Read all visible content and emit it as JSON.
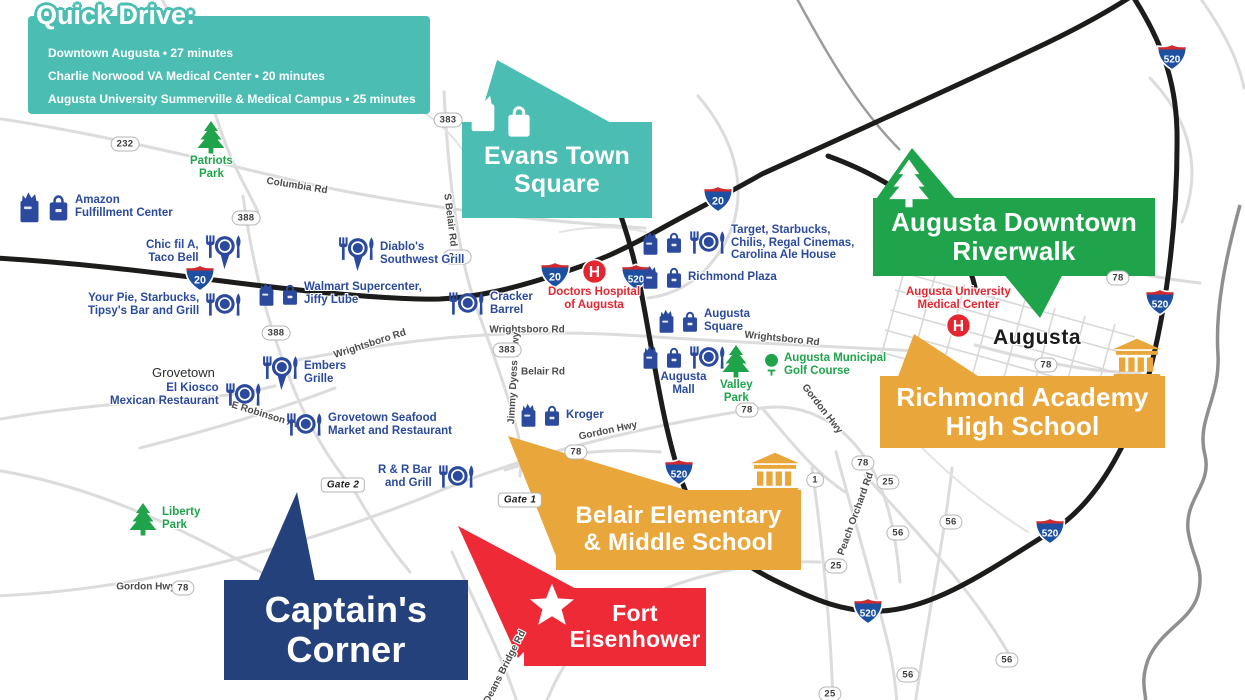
{
  "colors": {
    "teal": "#4CBDB2",
    "green": "#1FA44C",
    "orange": "#E9A63B",
    "red": "#ED2A35",
    "navy": "#24417C",
    "blue_label": "#2B4A9E",
    "red_label": "#E42630",
    "green_label": "#1FA44C",
    "road_black": "#1C1C1A",
    "road_gray": "#DCDCDC",
    "river_gray": "#8F8F8F"
  },
  "quick_drive": {
    "title": "Quick Drive:",
    "items": [
      "Downtown Augusta • 27 minutes",
      "Charlie Norwood VA Medical Center • 20 minutes",
      "Augusta University Summerville & Medical Campus • 25 minutes"
    ]
  },
  "callouts": {
    "evans": {
      "line1": "Evans Town",
      "line2": "Square"
    },
    "riverwalk": {
      "line1": "Augusta Downtown",
      "line2": "Riverwalk"
    },
    "richmond": {
      "line1": "Richmond Academy",
      "line2": "High School"
    },
    "belair": {
      "line1": "Belair Elementary",
      "line2": "& Middle School"
    },
    "fort": {
      "line1": "Fort",
      "line2": "Eisenhower"
    },
    "captains": {
      "line1": "Captain's",
      "line2": "Corner"
    }
  },
  "pois": [
    {
      "id": "amazon-fulfillment-center",
      "x": 16,
      "y": 190,
      "big": true,
      "icons": [
        "grocery",
        "shopping"
      ],
      "lines": [
        "Amazon",
        "Fulfillment Center"
      ]
    },
    {
      "id": "patriots-park",
      "x": 190,
      "y": 120,
      "style": "green",
      "layout": "col",
      "icons": [
        "tree"
      ],
      "lines": [
        "Patriots",
        "Park"
      ]
    },
    {
      "id": "chic-fil-a-taco-bell",
      "x": 146,
      "y": 234,
      "iconside": "right",
      "align": "right",
      "icons": [
        "restaurant-pin"
      ],
      "lines": [
        "Chic fil A,",
        "Taco Bell"
      ]
    },
    {
      "id": "diablos-southwest-grill",
      "x": 336,
      "y": 236,
      "icons": [
        "restaurant-pin"
      ],
      "lines": [
        "Diablo's",
        "Southwest Grill"
      ]
    },
    {
      "id": "your-pie-starbucks-tipsys",
      "x": 88,
      "y": 292,
      "iconside": "right",
      "align": "right",
      "icons": [
        "restaurant"
      ],
      "lines": [
        "Your Pie, Starbucks,",
        "Tipsy's Bar and Grill"
      ]
    },
    {
      "id": "walmart-supercenter-jiffy-lube",
      "x": 256,
      "y": 281,
      "icons": [
        "grocery",
        "shopping"
      ],
      "lines": [
        "Walmart Supercenter,",
        "Jiffy Lube"
      ]
    },
    {
      "id": "cracker-barrel",
      "x": 446,
      "y": 291,
      "icons": [
        "restaurant"
      ],
      "lines": [
        "Cracker",
        "Barrel"
      ]
    },
    {
      "id": "doctors-hospital-of-augusta",
      "x": 548,
      "y": 258,
      "style": "red",
      "layout": "col",
      "icons": [
        "hospital"
      ],
      "lines": [
        "Doctors Hospital",
        "of Augusta"
      ]
    },
    {
      "id": "target-starbucks-chilis",
      "x": 640,
      "y": 224,
      "icons": [
        "grocery",
        "shopping",
        "restaurant"
      ],
      "lines": [
        "Target, Starbucks,",
        "Chilis, Regal Cinemas,",
        "Carolina Ale House"
      ]
    },
    {
      "id": "richmond-plaza",
      "x": 640,
      "y": 264,
      "icons": [
        "grocery",
        "shopping"
      ],
      "lines": [
        "Richmond Plaza"
      ]
    },
    {
      "id": "augusta-square",
      "x": 656,
      "y": 308,
      "icons": [
        "grocery",
        "shopping"
      ],
      "lines": [
        "Augusta",
        "Square"
      ]
    },
    {
      "id": "augusta-mall",
      "x": 640,
      "y": 344,
      "layout": "col",
      "icons": [
        "grocery",
        "shopping",
        "restaurant"
      ],
      "lines": [
        "Augusta",
        "Mall"
      ]
    },
    {
      "id": "valley-park",
      "x": 720,
      "y": 344,
      "style": "green",
      "layout": "col",
      "icons": [
        "tree"
      ],
      "lines": [
        "Valley",
        "Park"
      ]
    },
    {
      "id": "augusta-municipal-golf-course",
      "x": 763,
      "y": 352,
      "style": "green",
      "icons": [
        "golf"
      ],
      "lines": [
        "Augusta Municipal",
        "Golf Course"
      ]
    },
    {
      "id": "augusta-university-medical-center",
      "x": 906,
      "y": 286,
      "style": "red",
      "layout": "col",
      "iconafter": true,
      "icons": [
        "hospital"
      ],
      "lines": [
        "Augusta University",
        "Medical Center"
      ]
    },
    {
      "id": "augusta-city",
      "x": 993,
      "y": 326,
      "style": "city",
      "icons": [],
      "lines": [
        "Augusta"
      ]
    },
    {
      "id": "grovetown-city",
      "x": 152,
      "y": 366,
      "style": "town",
      "icons": [],
      "lines": [
        "Grovetown"
      ]
    },
    {
      "id": "embers-grille",
      "x": 260,
      "y": 355,
      "icons": [
        "restaurant-pin"
      ],
      "lines": [
        "Embers",
        "Grille"
      ]
    },
    {
      "id": "el-kiosco-mexican-restaurant",
      "x": 110,
      "y": 382,
      "iconside": "right",
      "align": "right",
      "icons": [
        "restaurant"
      ],
      "lines": [
        "El Kiosco",
        "Mexican Restaurant"
      ]
    },
    {
      "id": "grovetown-seafood-market",
      "x": 284,
      "y": 412,
      "icons": [
        "restaurant"
      ],
      "lines": [
        "Grovetown Seafood",
        "Market and Restaurant"
      ]
    },
    {
      "id": "kroger",
      "x": 518,
      "y": 402,
      "icons": [
        "grocery",
        "shopping"
      ],
      "lines": [
        "Kroger"
      ]
    },
    {
      "id": "r-and-r-bar-and-grill",
      "x": 378,
      "y": 464,
      "iconside": "right",
      "align": "right",
      "icons": [
        "restaurant"
      ],
      "lines": [
        "R & R Bar",
        "and Grill"
      ]
    },
    {
      "id": "liberty-park",
      "x": 128,
      "y": 502,
      "style": "green",
      "icons": [
        "tree"
      ],
      "lines": [
        "Liberty",
        "Park"
      ]
    }
  ],
  "road_labels": [
    {
      "text": "Columbia Rd",
      "x": 297,
      "y": 186,
      "rot": 9
    },
    {
      "text": "Wrightsboro Rd",
      "x": 370,
      "y": 344,
      "rot": -18
    },
    {
      "text": "Wrightsboro Rd",
      "x": 527,
      "y": 330,
      "rot": 0
    },
    {
      "text": "Wrightsboro Rd",
      "x": 782,
      "y": 339,
      "rot": 6
    },
    {
      "text": "Belair Rd",
      "x": 543,
      "y": 372,
      "rot": 0
    },
    {
      "text": "S Belair Rd",
      "x": 450,
      "y": 220,
      "rot": 83
    },
    {
      "text": "Jimmy Dyess Pkwy",
      "x": 514,
      "y": 378,
      "rot": -87
    },
    {
      "text": "E Robinson Ave",
      "x": 268,
      "y": 416,
      "rot": 17
    },
    {
      "text": "Gordon Hwy",
      "x": 608,
      "y": 431,
      "rot": -12
    },
    {
      "text": "Gordon Hwy",
      "x": 822,
      "y": 409,
      "rot": 52
    },
    {
      "text": "Gordon Hwy",
      "x": 146,
      "y": 587,
      "rot": 0
    },
    {
      "text": "Deans Bridge Rd",
      "x": 505,
      "y": 667,
      "rot": -63
    },
    {
      "text": "Peach Orchard Rd",
      "x": 856,
      "y": 514,
      "rot": -70
    }
  ],
  "pills": [
    {
      "text": "232",
      "x": 125,
      "y": 144
    },
    {
      "text": "388",
      "x": 246,
      "y": 218
    },
    {
      "text": "388",
      "x": 276,
      "y": 333
    },
    {
      "text": "383",
      "x": 448,
      "y": 120
    },
    {
      "text": "383",
      "x": 457,
      "y": 257
    },
    {
      "text": "383",
      "x": 507,
      "y": 350
    },
    {
      "text": "78",
      "x": 576,
      "y": 452
    },
    {
      "text": "78",
      "x": 747,
      "y": 410
    },
    {
      "text": "78",
      "x": 1046,
      "y": 365
    },
    {
      "text": "78",
      "x": 1118,
      "y": 278
    },
    {
      "text": "78",
      "x": 863,
      "y": 463
    },
    {
      "text": "78",
      "x": 183,
      "y": 588
    },
    {
      "text": "25",
      "x": 888,
      "y": 482
    },
    {
      "text": "25",
      "x": 836,
      "y": 566
    },
    {
      "text": "25",
      "x": 830,
      "y": 694
    },
    {
      "text": "56",
      "x": 898,
      "y": 533
    },
    {
      "text": "56",
      "x": 951,
      "y": 522
    },
    {
      "text": "56",
      "x": 1007,
      "y": 660
    },
    {
      "text": "56",
      "x": 908,
      "y": 675
    },
    {
      "text": "1",
      "x": 815,
      "y": 480
    },
    {
      "text": "Gate 2",
      "x": 343,
      "y": 485,
      "kind": "gate"
    },
    {
      "text": "Gate 1",
      "x": 520,
      "y": 500,
      "kind": "gate"
    }
  ],
  "shields": [
    {
      "num": "20",
      "x": 200,
      "y": 278
    },
    {
      "num": "20",
      "x": 555,
      "y": 275
    },
    {
      "num": "20",
      "x": 718,
      "y": 199
    },
    {
      "num": "520",
      "x": 636,
      "y": 277
    },
    {
      "num": "520",
      "x": 679,
      "y": 472
    },
    {
      "num": "520",
      "x": 1172,
      "y": 57
    },
    {
      "num": "520",
      "x": 1160,
      "y": 302
    },
    {
      "num": "520",
      "x": 1050,
      "y": 531
    },
    {
      "num": "520",
      "x": 868,
      "y": 611
    }
  ],
  "overlays": [
    {
      "icon": "grocery",
      "x": 466,
      "y": 90,
      "w": 34,
      "h": 44,
      "color": "#FFFFFF"
    },
    {
      "icon": "shopping",
      "x": 504,
      "y": 102,
      "w": 30,
      "h": 38,
      "color": "#FFFFFF"
    },
    {
      "icon": "tree",
      "x": 886,
      "y": 158,
      "w": 46,
      "h": 50,
      "color": "#FFFFFF"
    },
    {
      "icon": "school",
      "x": 748,
      "y": 452,
      "w": 54,
      "h": 42,
      "color": "#E9A63B"
    },
    {
      "icon": "school",
      "x": 1110,
      "y": 338,
      "w": 54,
      "h": 42,
      "color": "#E9A63B"
    },
    {
      "icon": "star",
      "x": 528,
      "y": 582,
      "w": 48,
      "h": 46,
      "color": "#FFFFFF"
    }
  ]
}
